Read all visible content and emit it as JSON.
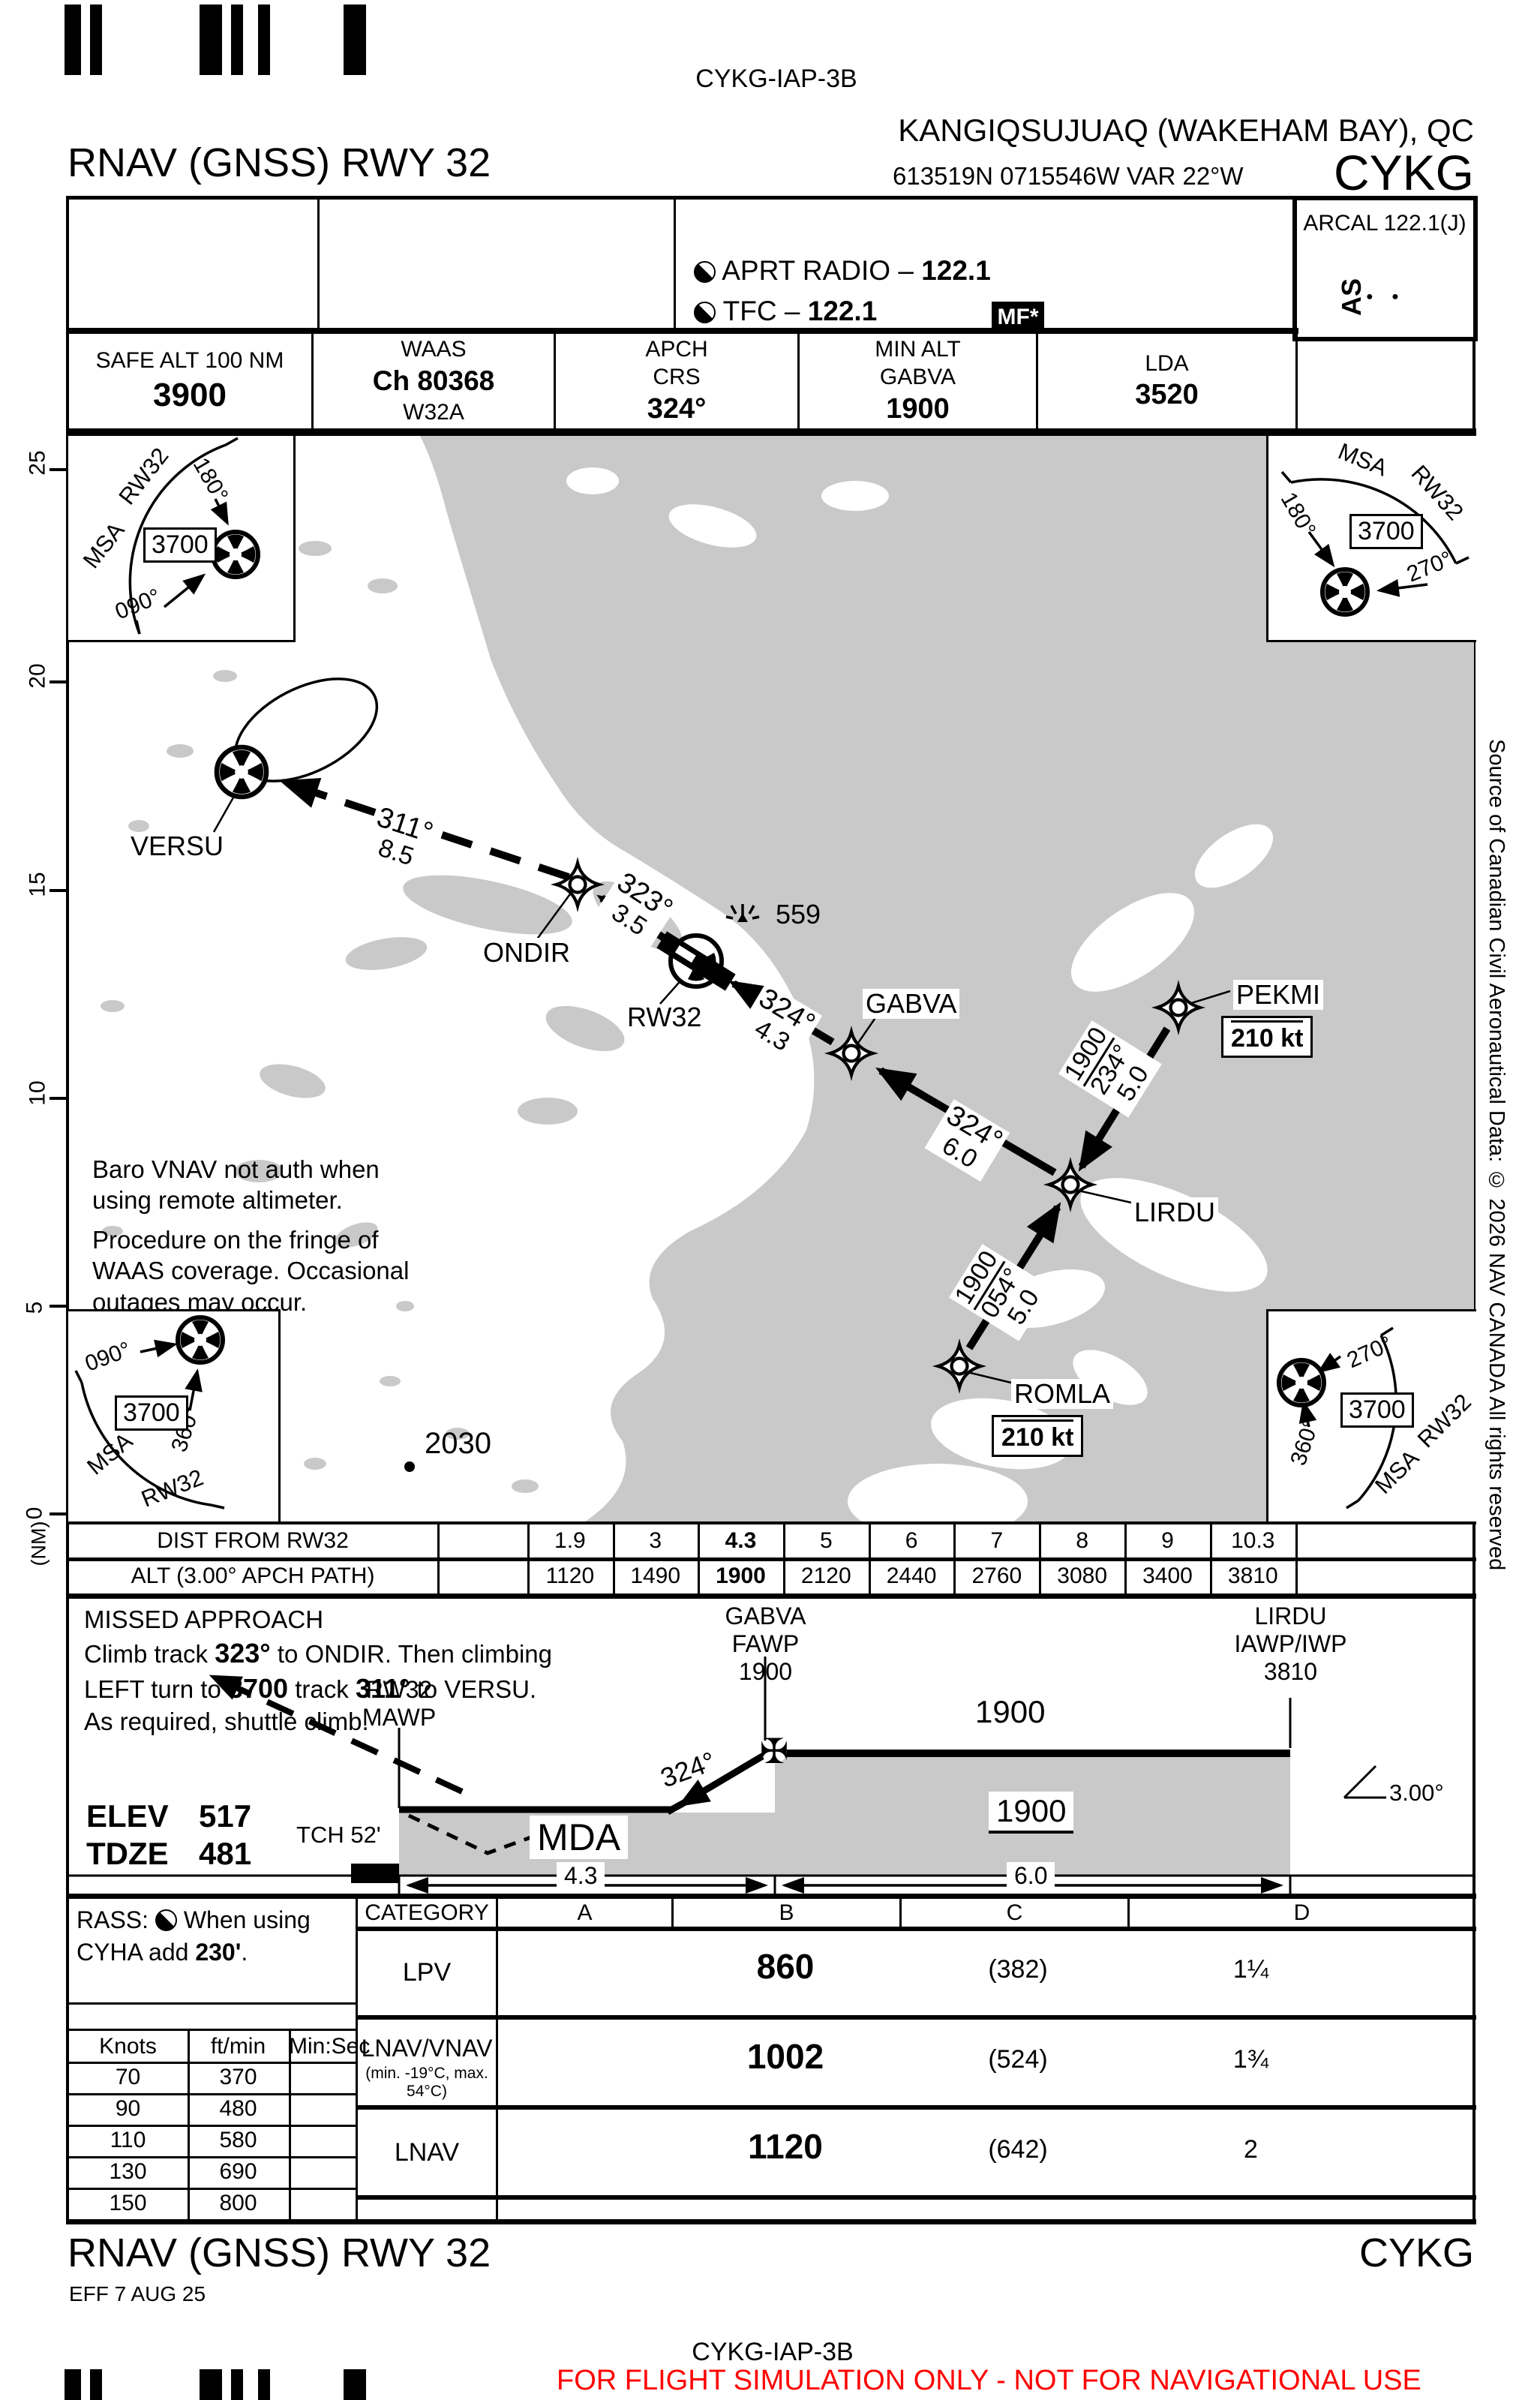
{
  "page": {
    "bg": "#ffffff",
    "ink": "#000000",
    "water_gray": "#c9c9c9",
    "warning_red": "#ff0000"
  },
  "header": {
    "chart_id": "CYKG-IAP-3B",
    "city": "KANGIQSUJUAQ (WAKEHAM BAY), QC",
    "procedure": "RNAV (GNSS) RWY 32",
    "position": "613519N 0715546W VAR 22°W",
    "icao": "CYKG"
  },
  "comm": {
    "apt_radio": "APRT RADIO – ",
    "apt_radio_freq": "122.1",
    "tfc": "TFC – ",
    "tfc_freq": "122.1",
    "mf": "MF*",
    "arcal": "ARCAL 122.1(J)",
    "arcal_ident": "AS",
    "arcal_morse": "● ●"
  },
  "databoxes": {
    "safe_alt_label": "SAFE ALT 100 NM",
    "safe_alt": "3900",
    "waas_label": "WAAS",
    "waas_channel": "Ch 80368",
    "waas_ident": "W32A",
    "apch_l1": "APCH",
    "apch_l2": "CRS",
    "apch_crs": "324°",
    "minalt_l1": "MIN ALT",
    "minalt_l2": "GABVA",
    "minalt": "1900",
    "lda_label": "LDA",
    "lda": "3520"
  },
  "msa": {
    "tl": {
      "msa": "MSA",
      "rwy": "RW32",
      "alt": "3700",
      "bearing_a": "180°",
      "bearing_b": "090°"
    },
    "tr": {
      "msa": "MSA",
      "rwy": "RW32",
      "alt": "3700",
      "bearing_a": "180°",
      "bearing_b": "270°"
    },
    "bl": {
      "msa": "MSA",
      "rwy": "RW32",
      "alt": "3700",
      "bearing_a": "090°",
      "bearing_b": "360°"
    },
    "br": {
      "msa": "MSA",
      "rwy": "RW32",
      "alt": "3700",
      "bearing_a": "270°",
      "bearing_b": "360°"
    }
  },
  "plan": {
    "waypoints": {
      "versu": "VERSU",
      "ondir": "ONDIR",
      "rw32": "RW32",
      "gabva": "GABVA",
      "pekmi": "PEKMI",
      "lirdu": "LIRDU",
      "romla": "ROMLA"
    },
    "speed_pekmi": "210 kt",
    "speed_romla": "210 kt",
    "legs": {
      "versu_ondir": {
        "track": "311°",
        "dist": "8.5"
      },
      "ondir_rw32": {
        "track": "323°",
        "dist": "3.5"
      },
      "gabva_rw32": {
        "track": "324°",
        "dist": "4.3"
      },
      "lirdu_gabva": {
        "track": "324°",
        "dist": "6.0"
      },
      "pekmi_lirdu": {
        "alt": "1900",
        "track": "234°",
        "dist": "5.0"
      },
      "romla_lirdu": {
        "alt": "1900",
        "track": "054°",
        "dist": "5.0"
      }
    },
    "obstacle_559": "559",
    "spot_elev": "2030",
    "note1": "Baro VNAV not auth when\nusing remote altimeter.",
    "note2": "Procedure on the fringe of\nWAAS coverage. Occasional\noutages may occur.",
    "nm_scale": [
      "25",
      "20",
      "15",
      "10",
      "5",
      "0"
    ],
    "nm_label": "(NM)"
  },
  "dist_table": {
    "row1_label": "DIST FROM RW32",
    "row2_label": "ALT (3.00° APCH PATH)",
    "dist": [
      "1.9",
      "3",
      "4.3",
      "5",
      "6",
      "7",
      "8",
      "9",
      "10.3"
    ],
    "alt": [
      "1120",
      "1490",
      "1900",
      "2120",
      "2440",
      "2760",
      "3080",
      "3400",
      "3810"
    ]
  },
  "profile": {
    "missed_title": "MISSED APPROACH",
    "missed_l2a": "Climb track ",
    "missed_l2b": "323°",
    "missed_l2c": " to ONDIR. Then climbing",
    "missed_l3a": "LEFT turn to ",
    "missed_l3b": "3700",
    "missed_l3c": " track ",
    "missed_l3d": "311°",
    "missed_l3e": " to VERSU.",
    "missed_l4": "As required, shuttle climb.",
    "mawp": "RW32\nMAWP",
    "fawp": "GABVA\nFAWP\n1900",
    "iawp": "LIRDU\nIAWP/IWP\n3810",
    "seg_alt": "1900",
    "mda_alt": "1900",
    "mda_label": "MDA",
    "track": "324°",
    "tch": "TCH 52'",
    "elev_label": "ELEV",
    "elev": "517",
    "tdze_label": "TDZE",
    "tdze": "481",
    "dim_mda": "4.3",
    "dim_int": "6.0",
    "angle": "3.00°",
    "faf_cross": "✠"
  },
  "minima": {
    "category_label": "CATEGORY",
    "cats": [
      "A",
      "B",
      "C",
      "D"
    ],
    "rows": [
      {
        "label": "LPV",
        "sub": "",
        "da": "860",
        "hat": "(382)",
        "vis": "1¼"
      },
      {
        "label": "LNAV/VNAV",
        "sub": "(min. -19°C, max. 54°C)",
        "da": "1002",
        "hat": "(524)",
        "vis": "1¾"
      },
      {
        "label": "LNAV",
        "sub": "",
        "da": "1120",
        "hat": "(642)",
        "vis": "2"
      }
    ]
  },
  "rass": {
    "l1a": "RASS:",
    "l1b": " When using CYHA",
    "l2a": "add ",
    "l2b": "230'",
    "l2c": "."
  },
  "rate_table": {
    "headers": [
      "Knots",
      "ft/min",
      "Min:Sec"
    ],
    "rows": [
      [
        "70",
        "370",
        ""
      ],
      [
        "90",
        "480",
        ""
      ],
      [
        "110",
        "580",
        ""
      ],
      [
        "130",
        "690",
        ""
      ],
      [
        "150",
        "800",
        ""
      ]
    ]
  },
  "footer": {
    "procedure": "RNAV (GNSS) RWY 32",
    "icao": "CYKG",
    "eff": "EFF 7 AUG 25",
    "chart_id": "CYKG-IAP-3B"
  },
  "side_note": "Source of Canadian Civil Aeronautical Data: © 2026 NAV CANADA All rights reserved",
  "disclaimer": "FOR FLIGHT SIMULATION ONLY - NOT FOR NAVIGATIONAL USE"
}
